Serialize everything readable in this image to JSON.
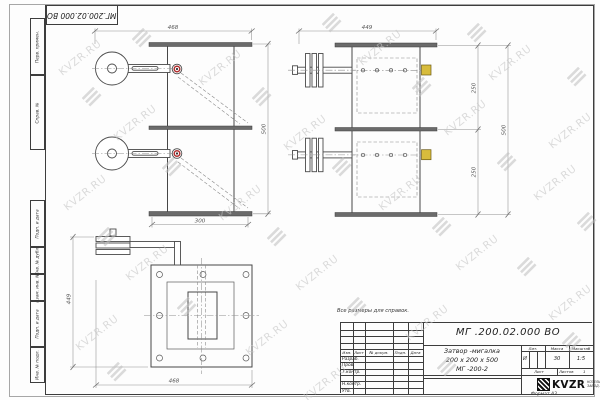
{
  "watermark": {
    "text": "KVZR.RU"
  },
  "corner_stamp": {
    "text": "МГ.200.02.000 ВО"
  },
  "margin_labels": [
    "Перв. примен.",
    "Справ. №",
    "Подп. и дата",
    "Инв. № дубл.",
    "Взам. инв. №",
    "Подп. и дата",
    "Инв. № подл."
  ],
  "note": "Все размеры для справок.",
  "dims": {
    "front_width": "468",
    "front_height": "500",
    "front_bottom": "300",
    "side_width": "449",
    "side_top_seg": "250",
    "side_bottom_seg": "250",
    "side_overall": "500",
    "plan_left": "449",
    "plan_bottom": "468"
  },
  "title_block": {
    "doc_number": "МГ .200.02.000 ВО",
    "name": "Затвор -мигалка",
    "size": "200 х 200 х 500",
    "model": "МГ -200-2",
    "cols": {
      "izm": "Изм.",
      "list": "Лист",
      "doc": "№ докум.",
      "podp": "Подп.",
      "data": "Дата"
    },
    "rows": [
      "Разраб.",
      "Пров.",
      "Т.контр.",
      "Н.контр.",
      "Утв."
    ],
    "lit_label": "Лит.",
    "mass_label": "Масса",
    "scale_label": "Масштаб",
    "lit_value": "И",
    "mass_value": "30",
    "scale_value": "1:5",
    "sheet_label": "Лист",
    "sheets_label": "Листов",
    "sheets_value": "1",
    "logo": "KVZR",
    "logo_line1": "КОТЕЛЬНЫЙ",
    "logo_line2": "ЗАВОД РФ",
    "format": "Формат А3"
  }
}
